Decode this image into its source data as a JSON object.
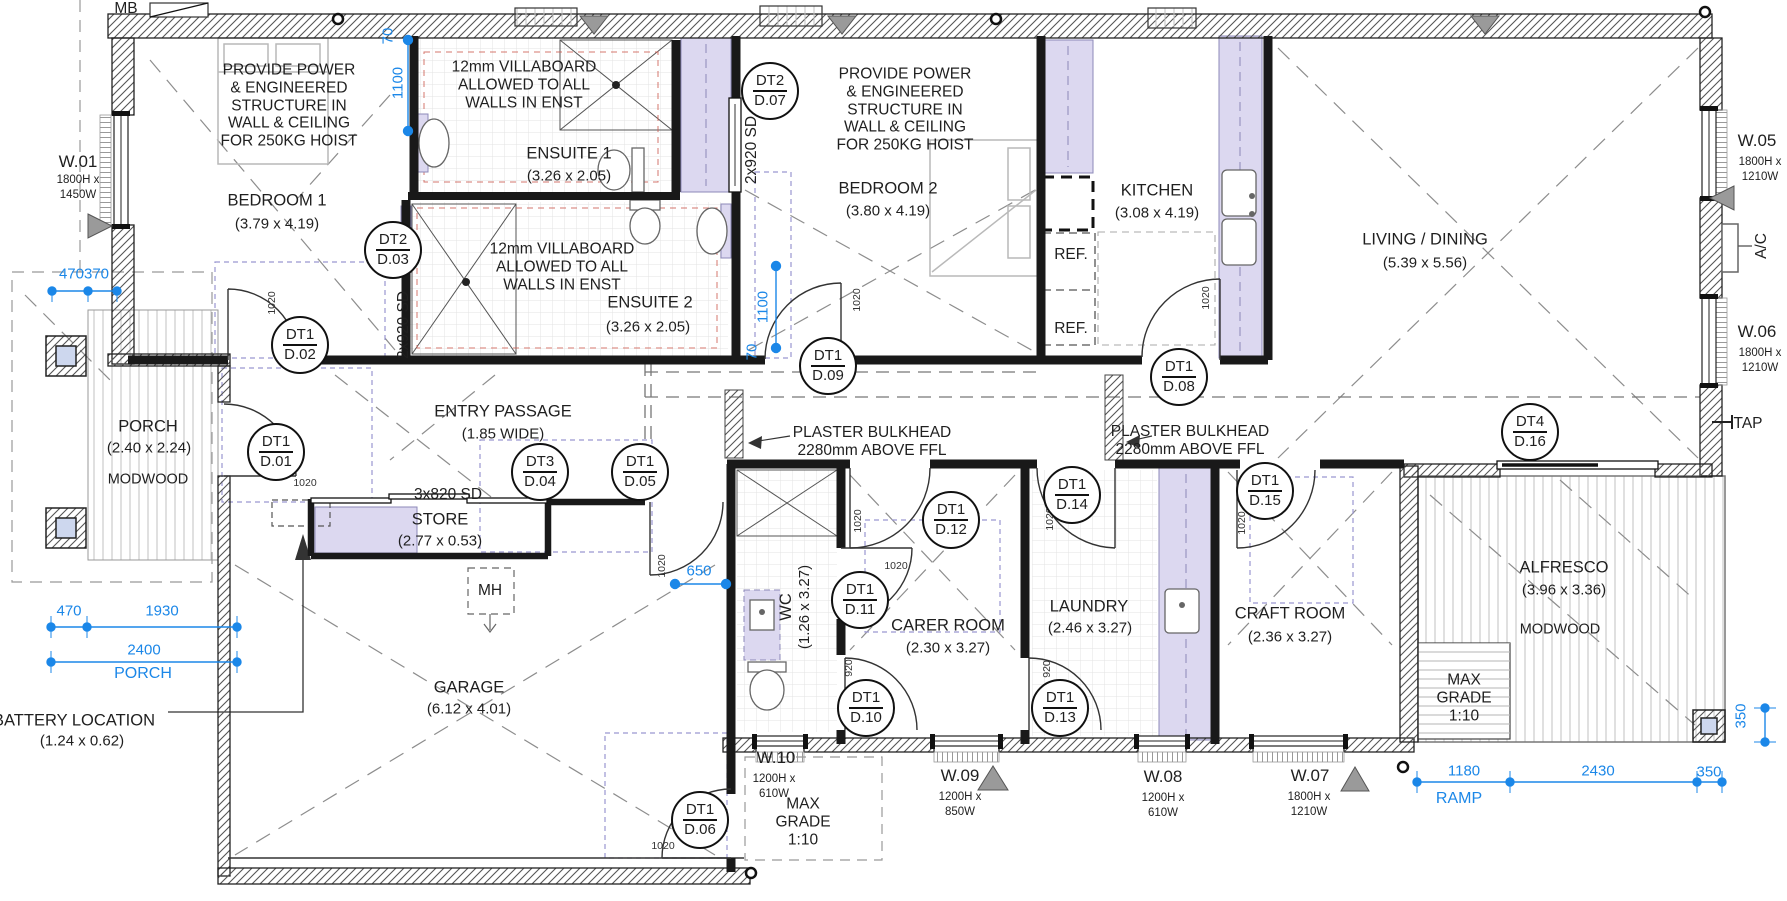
{
  "colors": {
    "dim_blue": "#1b87e8",
    "lavender": "#dcd8f0",
    "wall": "#1a1a1a",
    "red_dash": "#c96a5f"
  },
  "rooms": {
    "bedroom1": {
      "name": "BEDROOM 1",
      "size": "(3.79 x 4.19)"
    },
    "ensuite1": {
      "name": "ENSUITE 1",
      "size": "(3.26 x 2.05)"
    },
    "ensuite2": {
      "name": "ENSUITE 2",
      "size": "(3.26 x 2.05)"
    },
    "bedroom2": {
      "name": "BEDROOM 2",
      "size": "(3.80 x 4.19)"
    },
    "kitchen": {
      "name": "KITCHEN",
      "size": "(3.08 x 4.19)"
    },
    "living": {
      "name": "LIVING / DINING",
      "size": "(5.39 x 5.56)"
    },
    "entry": {
      "name": "ENTRY PASSAGE",
      "size": "(1.85 WIDE)"
    },
    "store": {
      "name": "STORE",
      "size": "(2.77 x 0.53)"
    },
    "garage": {
      "name": "GARAGE",
      "size": "(6.12 x 4.01)"
    },
    "porch": {
      "name": "PORCH",
      "size": "(2.40 x 2.24)",
      "material": "MODWOOD"
    },
    "wc": {
      "name": "WC",
      "size": "(1.26 x 3.27)"
    },
    "carer": {
      "name": "CARER ROOM",
      "size": "(2.30 x 3.27)"
    },
    "laundry": {
      "name": "LAUNDRY",
      "size": "(2.46 x 3.27)"
    },
    "craft": {
      "name": "CRAFT ROOM",
      "size": "(2.36 x 3.27)"
    },
    "alfresco": {
      "name": "ALFRESCO",
      "size": "(3.96 x 3.36)",
      "material": "MODWOOD"
    },
    "battery": {
      "name": "BATTERY LOCATION",
      "size": "(1.24 x 0.62)"
    }
  },
  "notes": {
    "hoist": {
      "l1": "PROVIDE POWER",
      "l2": "& ENGINEERED",
      "l3": "STRUCTURE IN",
      "l4": "WALL & CEILING",
      "l5": "FOR 250KG HOIST"
    },
    "villaboard": {
      "l1": "12mm VILLABOARD",
      "l2": "ALLOWED TO ALL",
      "l3": "WALLS IN ENST"
    },
    "bulkhead": {
      "l1": "PLASTER BULKHEAD",
      "l2": "2280mm ABOVE FFL"
    },
    "max_grade": {
      "l1": "MAX",
      "l2": "GRADE",
      "l3": "1:10"
    },
    "mh": "MH",
    "mb": "MB",
    "ref": "REF.",
    "tap": "TAP",
    "ac": "A/C",
    "sd2": "2x920 SD",
    "sd3": "3x820 SD"
  },
  "windows": {
    "w01": {
      "id": "W.01",
      "h": "1800H x",
      "w": "1450W"
    },
    "w05": {
      "id": "W.05",
      "h": "1800H x",
      "w": "1210W"
    },
    "w06": {
      "id": "W.06",
      "h": "1800H x",
      "w": "1210W"
    },
    "w07": {
      "id": "W.07",
      "h": "1800H x",
      "w": "1210W"
    },
    "w08": {
      "id": "W.08",
      "h": "1200H x",
      "w": "610W"
    },
    "w09": {
      "id": "W.09",
      "h": "1200H x",
      "w": "850W"
    },
    "w10": {
      "id": "W.10",
      "h": "1200H x",
      "w": "610W"
    }
  },
  "door_tags": {
    "d01": {
      "t": "DT1",
      "n": "D.01"
    },
    "d02": {
      "t": "DT1",
      "n": "D.02"
    },
    "d03": {
      "t": "DT2",
      "n": "D.03"
    },
    "d04": {
      "t": "DT3",
      "n": "D.04"
    },
    "d05": {
      "t": "DT1",
      "n": "D.05"
    },
    "d06": {
      "t": "DT1",
      "n": "D.06"
    },
    "d07": {
      "t": "DT2",
      "n": "D.07"
    },
    "d08": {
      "t": "DT1",
      "n": "D.08"
    },
    "d09": {
      "t": "DT1",
      "n": "D.09"
    },
    "d10": {
      "t": "DT1",
      "n": "D.10"
    },
    "d11": {
      "t": "DT1",
      "n": "D.11"
    },
    "d12": {
      "t": "DT1",
      "n": "D.12"
    },
    "d13": {
      "t": "DT1",
      "n": "D.13"
    },
    "d14": {
      "t": "DT1",
      "n": "D.14"
    },
    "d15": {
      "t": "DT1",
      "n": "D.15"
    },
    "d16": {
      "t": "DT4",
      "n": "D.16"
    }
  },
  "leaf": {
    "w1020": "1020",
    "w920": "920"
  },
  "dims": {
    "a470": "470",
    "a370": "370",
    "t70": "70",
    "t1100": "1100",
    "m1100": "1100",
    "m70": "70",
    "wc650": "650",
    "p470": "470",
    "p1930": "1930",
    "p2400": "2400",
    "porch": "PORCH",
    "b1180": "1180",
    "b2430": "2430",
    "b350": "350",
    "ramp": "RAMP",
    "r350": "350"
  }
}
